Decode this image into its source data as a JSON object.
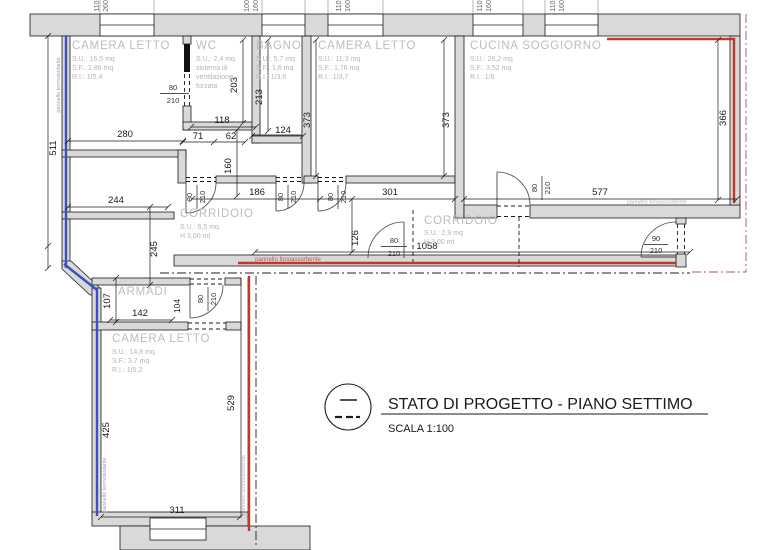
{
  "title_block": {
    "title": "STATO DI PROGETTO - PIANO SETTIMO",
    "scale": "SCALA 1:100"
  },
  "rooms": [
    {
      "name": "CAMERA LETTO",
      "lines": [
        "S.U.: 16,5 mq",
        "S.F.: 2,86 mq",
        "R.I.: 1/5,4"
      ]
    },
    {
      "name": "WC",
      "lines": [
        "S.U.: 2,4 mq",
        "sistema di",
        "ventilazione",
        "forzata"
      ]
    },
    {
      "name": "BAGNO",
      "lines": [
        "S.U.: 5,7 mq",
        "S.F.: 1,6 mq",
        "R.I.: 1/3,6"
      ]
    },
    {
      "name": "CAMERA LETTO",
      "lines": [
        "S.U.: 11,3 mq",
        "S.F.: 1,76 mq",
        "R.I.: 1/3,7"
      ]
    },
    {
      "name": "CUCINA SOGGIORNO",
      "lines": [
        "S.U.: 26,2 mq",
        "S.F.: 3,52 mq",
        "R.I.: 1/8"
      ]
    },
    {
      "name": "CORRIDOIO",
      "lines": [
        "S.U.: 6,5 mq",
        "H 3,00 mt"
      ]
    },
    {
      "name": "CORRIDOIO",
      "lines": [
        "S.U.: 2,9 mq",
        "H 3,00 mt"
      ]
    },
    {
      "name": "ARMADI",
      "lines": []
    },
    {
      "name": "CAMERA LETTO",
      "lines": [
        "S.U.: 14,8 mq",
        "S.F.: 3,7 mq",
        "R.I.: 1/5,2"
      ]
    }
  ],
  "dims": {
    "camera1_w": "280",
    "wc_w": "118",
    "wc_h": "203",
    "vest_a": "71",
    "vest_b": "62",
    "bagno_h": "213",
    "bagno_w": "124",
    "camera2_hl": "373",
    "camera2_hr": "373",
    "cucina_h": "366",
    "left_h": "511",
    "stub": "160",
    "corr_a": "186",
    "corr_b": "301",
    "cucina_w": "577",
    "arm_a": "244",
    "arm_b": "245",
    "corr_c": "126",
    "total": "1058",
    "armadi_h": "107",
    "armadi_w": "142",
    "armadi_d": "104",
    "camera3_hl": "425",
    "camera3_hr": "529",
    "camera3_w": "311"
  },
  "doors": {
    "w80": "80",
    "w90": "90",
    "h210": "210"
  },
  "windows": [
    {
      "a": "110",
      "b": "260"
    },
    {
      "a": "100",
      "b": "160"
    },
    {
      "a": "110",
      "b": "160"
    },
    {
      "a": "110",
      "b": "160"
    },
    {
      "a": "110",
      "b": "160"
    }
  ],
  "annotations": {
    "thermal": "pannello termoisolante",
    "acoustic": "pannello fonoassorbente"
  },
  "colors": {
    "wall": "#d9d9d9",
    "thermal_panel": "#3d4fc4",
    "acoustic_panel": "#c0392b",
    "room_label": "#bcbcbc"
  }
}
